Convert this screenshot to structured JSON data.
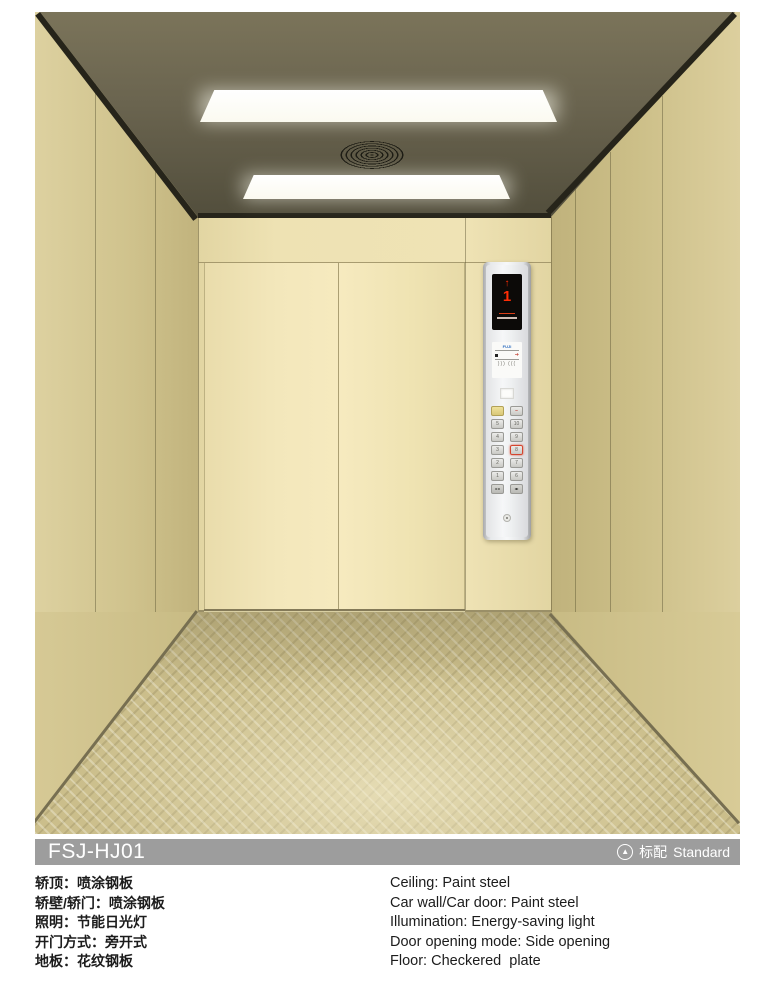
{
  "photo": {
    "description": "Freight elevator car interior render",
    "cop": {
      "display": {
        "direction_icon": "↑",
        "floor": "1"
      },
      "brand": "FUJI",
      "sticker_arrow": "➔",
      "sticker_waves": ")))  (((",
      "buttons": {
        "alarm_label": "",
        "stop_label": "–",
        "left_col": [
          "5",
          "4",
          "3",
          "2",
          "1"
        ],
        "right_col": [
          "10",
          "9",
          "8",
          "7",
          "6"
        ],
        "active_button": "8",
        "door_close_icon": "▸◂",
        "door_open_icon": "◂▸"
      }
    }
  },
  "model_bar": {
    "model": "FSJ-HJ01",
    "badge_icon": "▲",
    "badge_cn": "标配",
    "badge_en": "Standard"
  },
  "specs": {
    "cn": [
      "轿顶：喷涂钢板",
      "轿壁/轿门：喷涂钢板",
      "照明：节能日光灯",
      "开门方式：旁开式",
      "地板：花纹钢板"
    ],
    "en": [
      "Ceiling: Paint steel",
      "Car wall/Car door: Paint steel",
      "Illumination: Energy-saving light",
      "Door opening mode: Side opening",
      "Floor: Checkered  plate"
    ]
  },
  "colors": {
    "wall_beige": "#eee2b3",
    "ceiling_olive": "#5c5744",
    "bar_gray": "#9d9d9d",
    "indicator_red": "#ff2d05"
  }
}
